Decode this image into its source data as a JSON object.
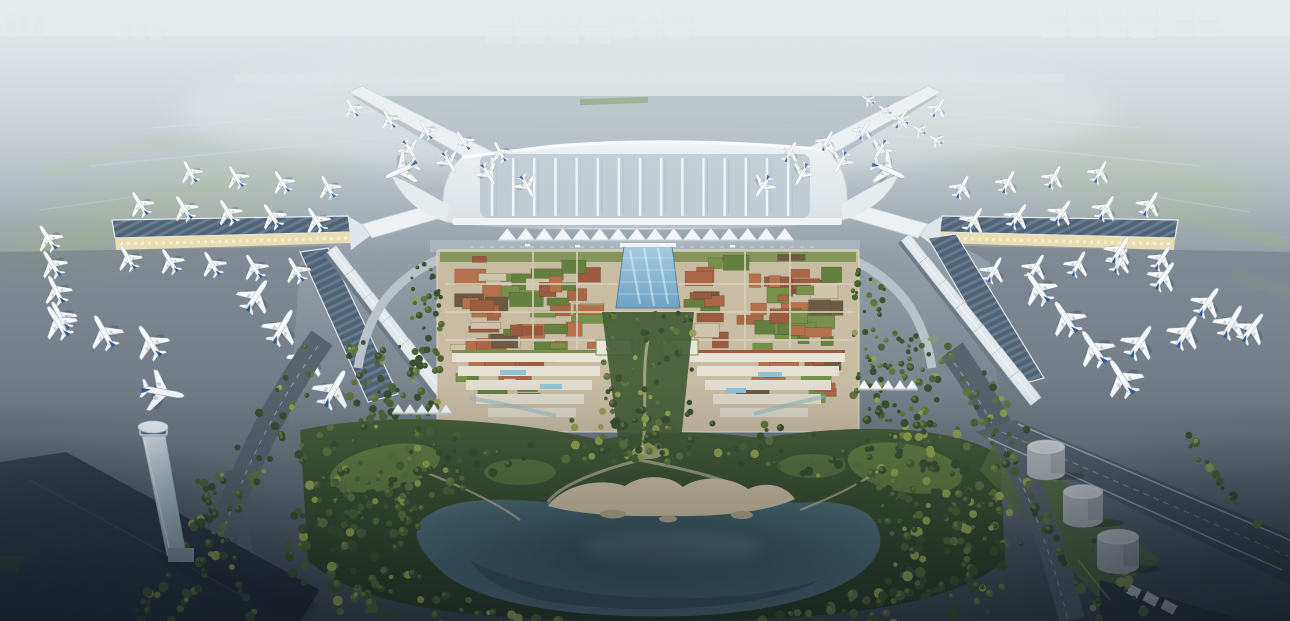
{
  "meta": {
    "width": 1290,
    "height": 621,
    "title": "Aerial architectural rendering of an airport terminal campus"
  },
  "scene": {
    "description": "Hazy daytime aerial rendering of a large X-plan airport. Four angled concourse arms and two long solar-roofed piers are lined with parked white airliners with blue tail fins. Behind a white ridged terminal roof, a tented canopy and elevated kerbside road front a dense landside village of terracotta and planted green roofs split by a blue glass atrium spine. A tree-filled central park with winding sandy paths descends to a dark lake with a beach. An air traffic control tower stands at lower left, three fuel-farm tanks at lower right, and tree-lined roads curve to the dark foreground. Runways and warehouse blocks fade into fog at the horizon.",
    "time_of_day": "soft overcast haze, low evening light in foreground",
    "landmarks": [
      "x-shaped-terminal",
      "concourse-arms",
      "solar-roof-piers",
      "parked-airliners",
      "tented-canopy",
      "landside-roof-village",
      "glass-atrium-spine",
      "terraced-white-buildings",
      "central-park",
      "lake-with-beach",
      "control-tower",
      "fuel-farm-tanks",
      "tree-lined-roads",
      "gabled-airside-blocks",
      "distant-warehouses",
      "runways-in-haze"
    ]
  },
  "palette": {
    "sky_top": "#d6dee1",
    "sky_mid": "#b7c2c9",
    "airfield_far": "#a9b4bb",
    "airfield_mid": "#8f9aa3",
    "apron_dark": "#6a7580",
    "ground_bottom": "#3a434d",
    "taxi_line": "#c6cfd4",
    "green_patch": "#9aa88d",
    "terminal_white": "#f0f3f5",
    "terminal_base": "#d7dee3",
    "rib_panel": "#bfcad2",
    "pier_edge": "#eef1f3",
    "cream_lit": "#e9ddb4",
    "arcade_dark": "#8a8062",
    "solar_a": "#4f6175",
    "solar_b": "#647a8e",
    "box_top": "#e2e8ec",
    "box_side": "#6e7a85",
    "plane_white": "#f6f8f9",
    "plane_grey": "#c9d1d6",
    "plane_blue": "#2f5a9e",
    "complex_base": "#c8bca3",
    "street": "#d9d0bb",
    "atrium_blue1": "#a6cbe1",
    "atrium_blue2": "#6fa2c5",
    "park_mid": "#465f38",
    "park_dark": "#273622",
    "lawn": "#6d8747",
    "sand": "#cfc3a4",
    "sand_dark": "#b6aa8c",
    "lake_edge": "#5d7d85",
    "lake_mid": "#446570",
    "lake_deep": "#2f4751",
    "road_mid": "#59636d",
    "lane": "#c3ccd2",
    "tower_light": "#dde6ec",
    "tower_mid": "#9fb3c2",
    "droof_a": "#3e4a58",
    "droof_b": "#1f2630",
    "exp_a": "#5e6a74",
    "exp_b": "#39444e",
    "tank_top": "#ccd0d3",
    "tank_body": "#adb2b7",
    "tank_shade": "#848b92",
    "canopy_white": "#f3f5f6",
    "hedge": "#87986a",
    "water_stream": "#8fb3c0"
  },
  "render": {
    "seed": 7,
    "terminal": {
      "rib_count": 15,
      "rib_x0": 492,
      "rib_dx": 21.15,
      "rib_y1": 158,
      "rib_y2": 216
    },
    "planes": {
      "clusters": [
        {
          "name": "far-left-column",
          "x": 48,
          "y": 238,
          "count": 4,
          "dx": 4,
          "dy": 26,
          "rot": -30,
          "scale": 0.8
        },
        {
          "name": "left-pier-north-row",
          "x": 140,
          "y": 204,
          "count": 5,
          "dx": 44,
          "dy": 4,
          "rot": -32,
          "scale": 0.8
        },
        {
          "name": "left-pier-outer-row",
          "x": 190,
          "y": 172,
          "count": 4,
          "dx": 46,
          "dy": 5,
          "rot": -30,
          "scale": 0.76
        },
        {
          "name": "left-pier-south-row",
          "x": 128,
          "y": 258,
          "count": 5,
          "dx": 42,
          "dy": 3,
          "rot": -30,
          "scale": 0.74
        },
        {
          "name": "left-corner-row",
          "x": 58,
          "y": 322,
          "count": 3,
          "dx": 46,
          "dy": 10,
          "rot": -32,
          "scale": 0.9
        },
        {
          "name": "west-connector-row",
          "x": 256,
          "y": 296,
          "count": 4,
          "dx": 26,
          "dy": 31,
          "rot": 32,
          "scale": 0.95
        },
        {
          "name": "northwest-arm-outer",
          "x": 352,
          "y": 108,
          "count": 5,
          "dx": 37,
          "dy": 11,
          "rot": -30,
          "scale": 0.72
        },
        {
          "name": "northwest-arm-inner",
          "x": 410,
          "y": 150,
          "count": 4,
          "dx": 39,
          "dy": 12,
          "rot": 148,
          "scale": 0.75
        },
        {
          "name": "taxiing-west-widebody",
          "x": 402,
          "y": 170,
          "count": 1,
          "dx": 0,
          "dy": 0,
          "rot": -115,
          "scale": 1.1
        },
        {
          "name": "northeast-arm-outer",
          "x": 938,
          "y": 108,
          "count": 5,
          "dx": -37,
          "dy": 11,
          "rot": 30,
          "scale": 0.72
        },
        {
          "name": "northeast-arm-inner",
          "x": 880,
          "y": 150,
          "count": 4,
          "dx": -39,
          "dy": 12,
          "rot": -148,
          "scale": 0.75
        },
        {
          "name": "taxiing-east-widebody",
          "x": 888,
          "y": 170,
          "count": 1,
          "dx": 0,
          "dy": 0,
          "rot": 115,
          "scale": 1.1
        },
        {
          "name": "right-pier-north-row",
          "x": 1150,
          "y": 204,
          "count": 5,
          "dx": -44,
          "dy": 4,
          "rot": 32,
          "scale": 0.8
        },
        {
          "name": "right-pier-outer-row",
          "x": 1100,
          "y": 172,
          "count": 4,
          "dx": -46,
          "dy": 5,
          "rot": 30,
          "scale": 0.76
        },
        {
          "name": "right-pier-south-row",
          "x": 1162,
          "y": 258,
          "count": 5,
          "dx": -42,
          "dy": 3,
          "rot": 30,
          "scale": 0.74
        },
        {
          "name": "right-corner-row",
          "x": 1232,
          "y": 322,
          "count": 3,
          "dx": -46,
          "dy": 10,
          "rot": 32,
          "scale": 0.9
        },
        {
          "name": "east-connector-row",
          "x": 1038,
          "y": 288,
          "count": 4,
          "dx": 28,
          "dy": 30,
          "rot": -35,
          "scale": 0.95
        },
        {
          "name": "east-remote-diagonal",
          "x": 1120,
          "y": 250,
          "count": 4,
          "dx": 44,
          "dy": 26,
          "rot": 35,
          "scale": 0.85
        },
        {
          "name": "northeast-remote-stand",
          "x": 868,
          "y": 100,
          "count": 5,
          "dx": 17,
          "dy": 10,
          "rot": -58,
          "scale": 0.5
        },
        {
          "name": "taxiway-plane-near-tower",
          "x": 162,
          "y": 392,
          "count": 1,
          "dx": 0,
          "dy": 0,
          "rot": 100,
          "scale": 1.0
        }
      ]
    },
    "boxrows": [
      {
        "name": "west-airside-blocks",
        "x1": 336,
        "y1": 264,
        "x2": 446,
        "y2": 408,
        "count": 7,
        "w": 34,
        "h": 13
      },
      {
        "name": "east-airside-blocks",
        "x1": 910,
        "y1": 252,
        "x2": 1020,
        "y2": 392,
        "count": 7,
        "w": 34,
        "h": 13
      }
    ],
    "roofs": {
      "blocks": [
        {
          "x": 447,
          "y": 254,
          "w": 160,
          "h": 102,
          "count": 48
        },
        {
          "x": 683,
          "y": 254,
          "w": 160,
          "h": 102,
          "count": 48
        },
        {
          "x": 449,
          "y": 352,
          "w": 108,
          "h": 52,
          "count": 14
        },
        {
          "x": 733,
          "y": 352,
          "w": 108,
          "h": 52,
          "count": 14
        }
      ],
      "colors": [
        [
          "#9b5b40",
          0.2
        ],
        [
          "#aa6747",
          0.2
        ],
        [
          "#b5714b",
          0.12
        ],
        [
          "#64803f",
          0.18
        ],
        [
          "#77914b",
          0.12
        ],
        [
          "#cfc5ab",
          0.1
        ],
        [
          "#6b5b43",
          0.08
        ]
      ]
    },
    "trees": {
      "belts": [
        {
          "t": "ring",
          "cx": 652,
          "cy": 543,
          "rx": 250,
          "ry": 84,
          "f1": 1.0,
          "f2": 1.5,
          "n": 400
        },
        {
          "t": "rect",
          "x": 298,
          "y": 424,
          "w": 135,
          "h": 125,
          "n": 80
        },
        {
          "t": "rect",
          "x": 878,
          "y": 420,
          "w": 135,
          "h": 130,
          "n": 85
        },
        {
          "t": "rect",
          "x": 602,
          "y": 312,
          "w": 92,
          "h": 150,
          "n": 90
        },
        {
          "t": "rect",
          "x": 408,
          "y": 262,
          "w": 34,
          "h": 158,
          "n": 50
        },
        {
          "t": "rect",
          "x": 852,
          "y": 262,
          "w": 34,
          "h": 158,
          "n": 50
        },
        {
          "t": "rect",
          "x": 348,
          "y": 336,
          "w": 66,
          "h": 92,
          "n": 48
        },
        {
          "t": "rect",
          "x": 876,
          "y": 332,
          "w": 66,
          "h": 92,
          "n": 48
        },
        {
          "t": "line",
          "x1": 330,
          "y1": 342,
          "x2": 176,
          "y2": 618,
          "n": 44,
          "j": 7
        },
        {
          "t": "line",
          "x1": 302,
          "y1": 348,
          "x2": 140,
          "y2": 618,
          "n": 36,
          "j": 6
        },
        {
          "t": "line",
          "x1": 942,
          "y1": 346,
          "x2": 1102,
          "y2": 618,
          "n": 44,
          "j": 7
        },
        {
          "t": "line",
          "x1": 966,
          "y1": 352,
          "x2": 1146,
          "y2": 612,
          "n": 36,
          "j": 6
        },
        {
          "t": "line",
          "x1": 198,
          "y1": 472,
          "x2": 252,
          "y2": 620,
          "n": 24,
          "j": 5
        },
        {
          "t": "line",
          "x1": 1186,
          "y1": 432,
          "x2": 1278,
          "y2": 558,
          "n": 16,
          "j": 6
        },
        {
          "t": "line",
          "x1": 908,
          "y1": 396,
          "x2": 986,
          "y2": 616,
          "n": 26,
          "j": 6
        }
      ],
      "colors": [
        [
          "#3a5030",
          0.4
        ],
        [
          "#4d6337",
          0.25
        ],
        [
          "#5f7440",
          0.2
        ],
        [
          "#93a050",
          0.15
        ]
      ],
      "lake": {
        "cx": 652,
        "cy": 545,
        "rx": 238,
        "ry": 72
      }
    },
    "tents": [
      {
        "name": "terminal-canopy",
        "x": 498,
        "y": 228,
        "count": 16,
        "w": 18.5,
        "h": 12
      },
      {
        "name": "west-plaza-tents",
        "x": 392,
        "y": 404,
        "count": 5,
        "w": 12,
        "h": 9
      },
      {
        "name": "east-plaza-tents",
        "x": 858,
        "y": 380,
        "count": 5,
        "w": 12,
        "h": 9
      }
    ],
    "tanks": [
      {
        "cx": 1046,
        "cy": 447,
        "r": 19,
        "h": 26
      },
      {
        "cx": 1083,
        "cy": 492,
        "r": 20,
        "h": 28
      },
      {
        "cx": 1118,
        "cy": 537,
        "r": 21,
        "h": 29
      }
    ],
    "warehouses": [
      {
        "x": 486,
        "y": 14,
        "cols": 4,
        "rows": 2,
        "w": 26,
        "h": 12,
        "gx": 7,
        "gy": 6,
        "o": 0.5
      },
      {
        "x": 612,
        "y": 10,
        "cols": 3,
        "rows": 2,
        "w": 22,
        "h": 12,
        "gx": 6,
        "gy": 5,
        "o": 0.45
      },
      {
        "x": 1042,
        "y": 6,
        "cols": 4,
        "rows": 2,
        "w": 24,
        "h": 13,
        "gx": 6,
        "gy": 6,
        "o": 0.55
      },
      {
        "x": 1172,
        "y": 10,
        "cols": 2,
        "rows": 2,
        "w": 20,
        "h": 11,
        "gx": 5,
        "gy": 5,
        "o": 0.45
      },
      {
        "x": 116,
        "y": 26,
        "cols": 3,
        "rows": 1,
        "w": 12,
        "h": 14,
        "gx": 5,
        "gy": 0,
        "o": 0.4
      }
    ],
    "green_patches": [
      [
        40,
        150,
        130,
        13,
        -16
      ],
      [
        95,
        190,
        150,
        15,
        -16
      ],
      [
        30,
        232,
        110,
        13,
        -16
      ],
      [
        160,
        130,
        96,
        10,
        -14
      ],
      [
        260,
        105,
        86,
        9,
        -10
      ],
      [
        330,
        74,
        110,
        9,
        -6
      ],
      [
        520,
        56,
        92,
        7,
        -2
      ],
      [
        700,
        52,
        104,
        7,
        3
      ],
      [
        940,
        86,
        100,
        9,
        10
      ],
      [
        1010,
        120,
        130,
        11,
        13
      ],
      [
        1090,
        168,
        150,
        13,
        15
      ],
      [
        1160,
        220,
        130,
        14,
        16
      ],
      [
        1230,
        280,
        80,
        13,
        18
      ],
      [
        880,
        120,
        70,
        8,
        8
      ]
    ]
  }
}
